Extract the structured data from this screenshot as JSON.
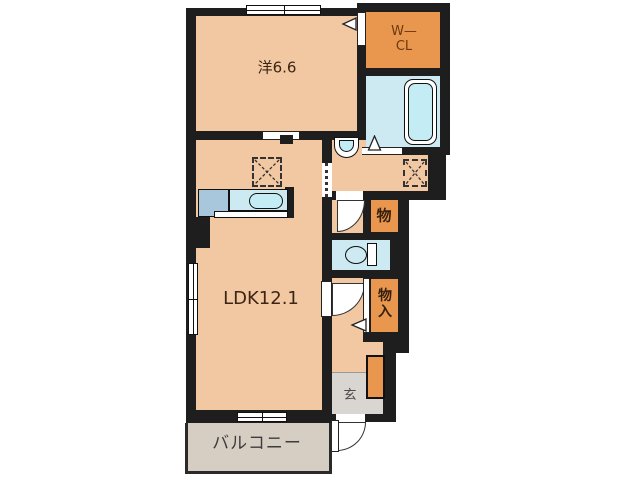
{
  "rooms": {
    "bedroom": {
      "label": "洋6.6"
    },
    "wcl": {
      "line1": "W—",
      "line2": "CL"
    },
    "ldk": {
      "label": "LDK12.1"
    },
    "storage": {
      "label": "物"
    },
    "closet": {
      "line1": "物",
      "line2": "入"
    },
    "entrance": {
      "label": "玄"
    },
    "balcony": {
      "label": "バルコニー"
    }
  },
  "colors": {
    "wall": "#1e1e1e",
    "room_floor": "#f2c8a2",
    "closet_orange": "#e9964e",
    "wet_area_blue": "#cde9f1",
    "fixture_cyan": "#c3ecf5",
    "counter_blue": "#a9c7dc",
    "entry_gray": "#d9d6d2",
    "balcony_gray": "#d6cec3",
    "label_brown": "#3d2414"
  }
}
